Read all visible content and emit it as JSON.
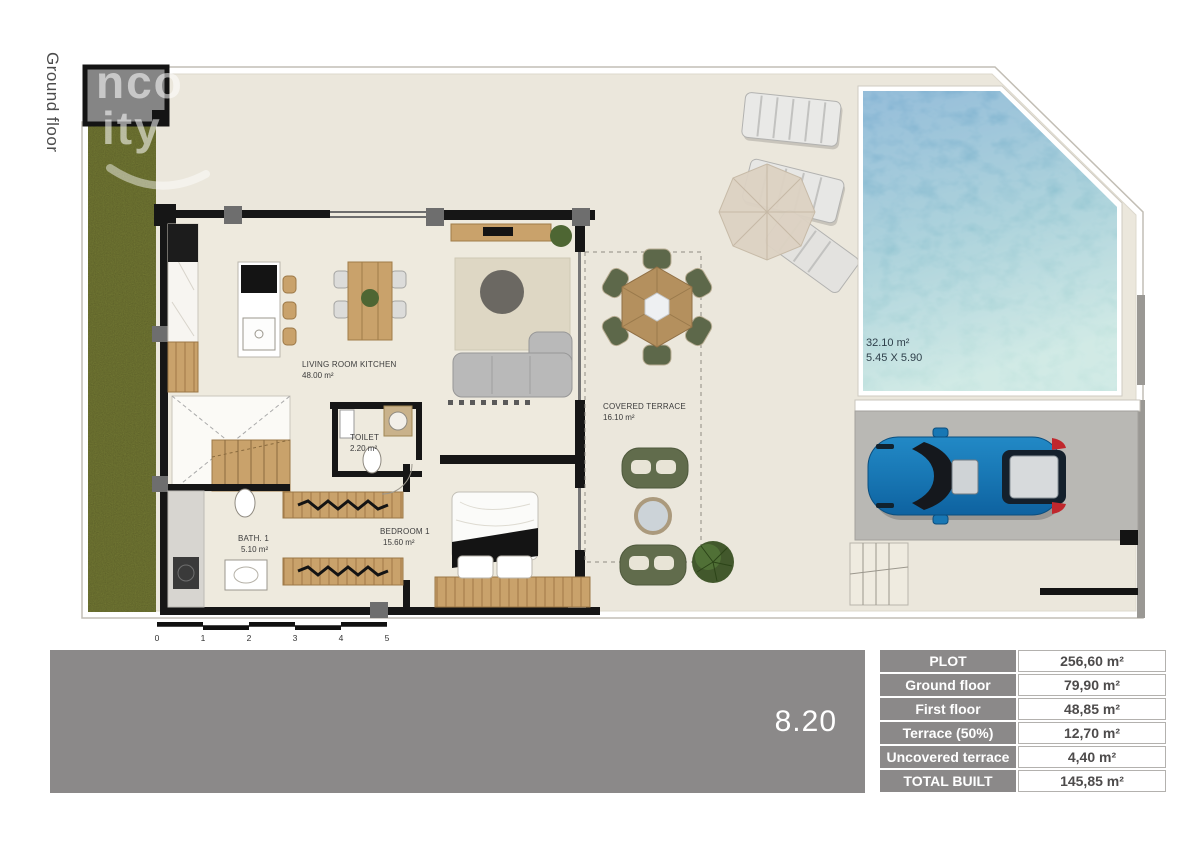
{
  "page": {
    "side_label": "Ground floor",
    "watermark_line1": "nco",
    "watermark_line2": "ity"
  },
  "plan": {
    "rooms": [
      {
        "name": "LIVING ROOM KITCHEN",
        "area": "48.00 m²"
      },
      {
        "name": "TOILET",
        "area": "2.20 m²"
      },
      {
        "name": "BATH. 1",
        "area": "5.10 m²"
      },
      {
        "name": "BEDROOM 1",
        "area": "15.60 m²"
      },
      {
        "name": "COVERED TERRACE",
        "area": "16.10 m²"
      }
    ],
    "pool": {
      "area": "32.10 m²",
      "dimensions": "5.45 X 5.90"
    },
    "scale_ticks": [
      "0",
      "1",
      "2",
      "3",
      "4",
      "5"
    ]
  },
  "footer": {
    "width_label": "8.20"
  },
  "areas_table": {
    "rows": [
      {
        "label": "PLOT",
        "value": "256,60 m²"
      },
      {
        "label": "Ground floor",
        "value": "79,90 m²"
      },
      {
        "label": "First floor",
        "value": "48,85 m²"
      },
      {
        "label": "Terrace (50%)",
        "value": "12,70 m²"
      },
      {
        "label": "Uncovered terrace",
        "value": "4,40 m²"
      },
      {
        "label": "TOTAL BUILT",
        "value": "145,85 m²"
      }
    ]
  },
  "colors": {
    "floor_cream": "#ebe7dc",
    "garden_green": "#7d8338",
    "pool_top": "#6ca4cb",
    "pool_bottom": "#bfe2dc",
    "wall_black": "#161616",
    "wood": "#c9a26b",
    "olive_furniture": "#5d684a",
    "footer_gray": "#8b8989",
    "car_blue": "#1877b4"
  }
}
